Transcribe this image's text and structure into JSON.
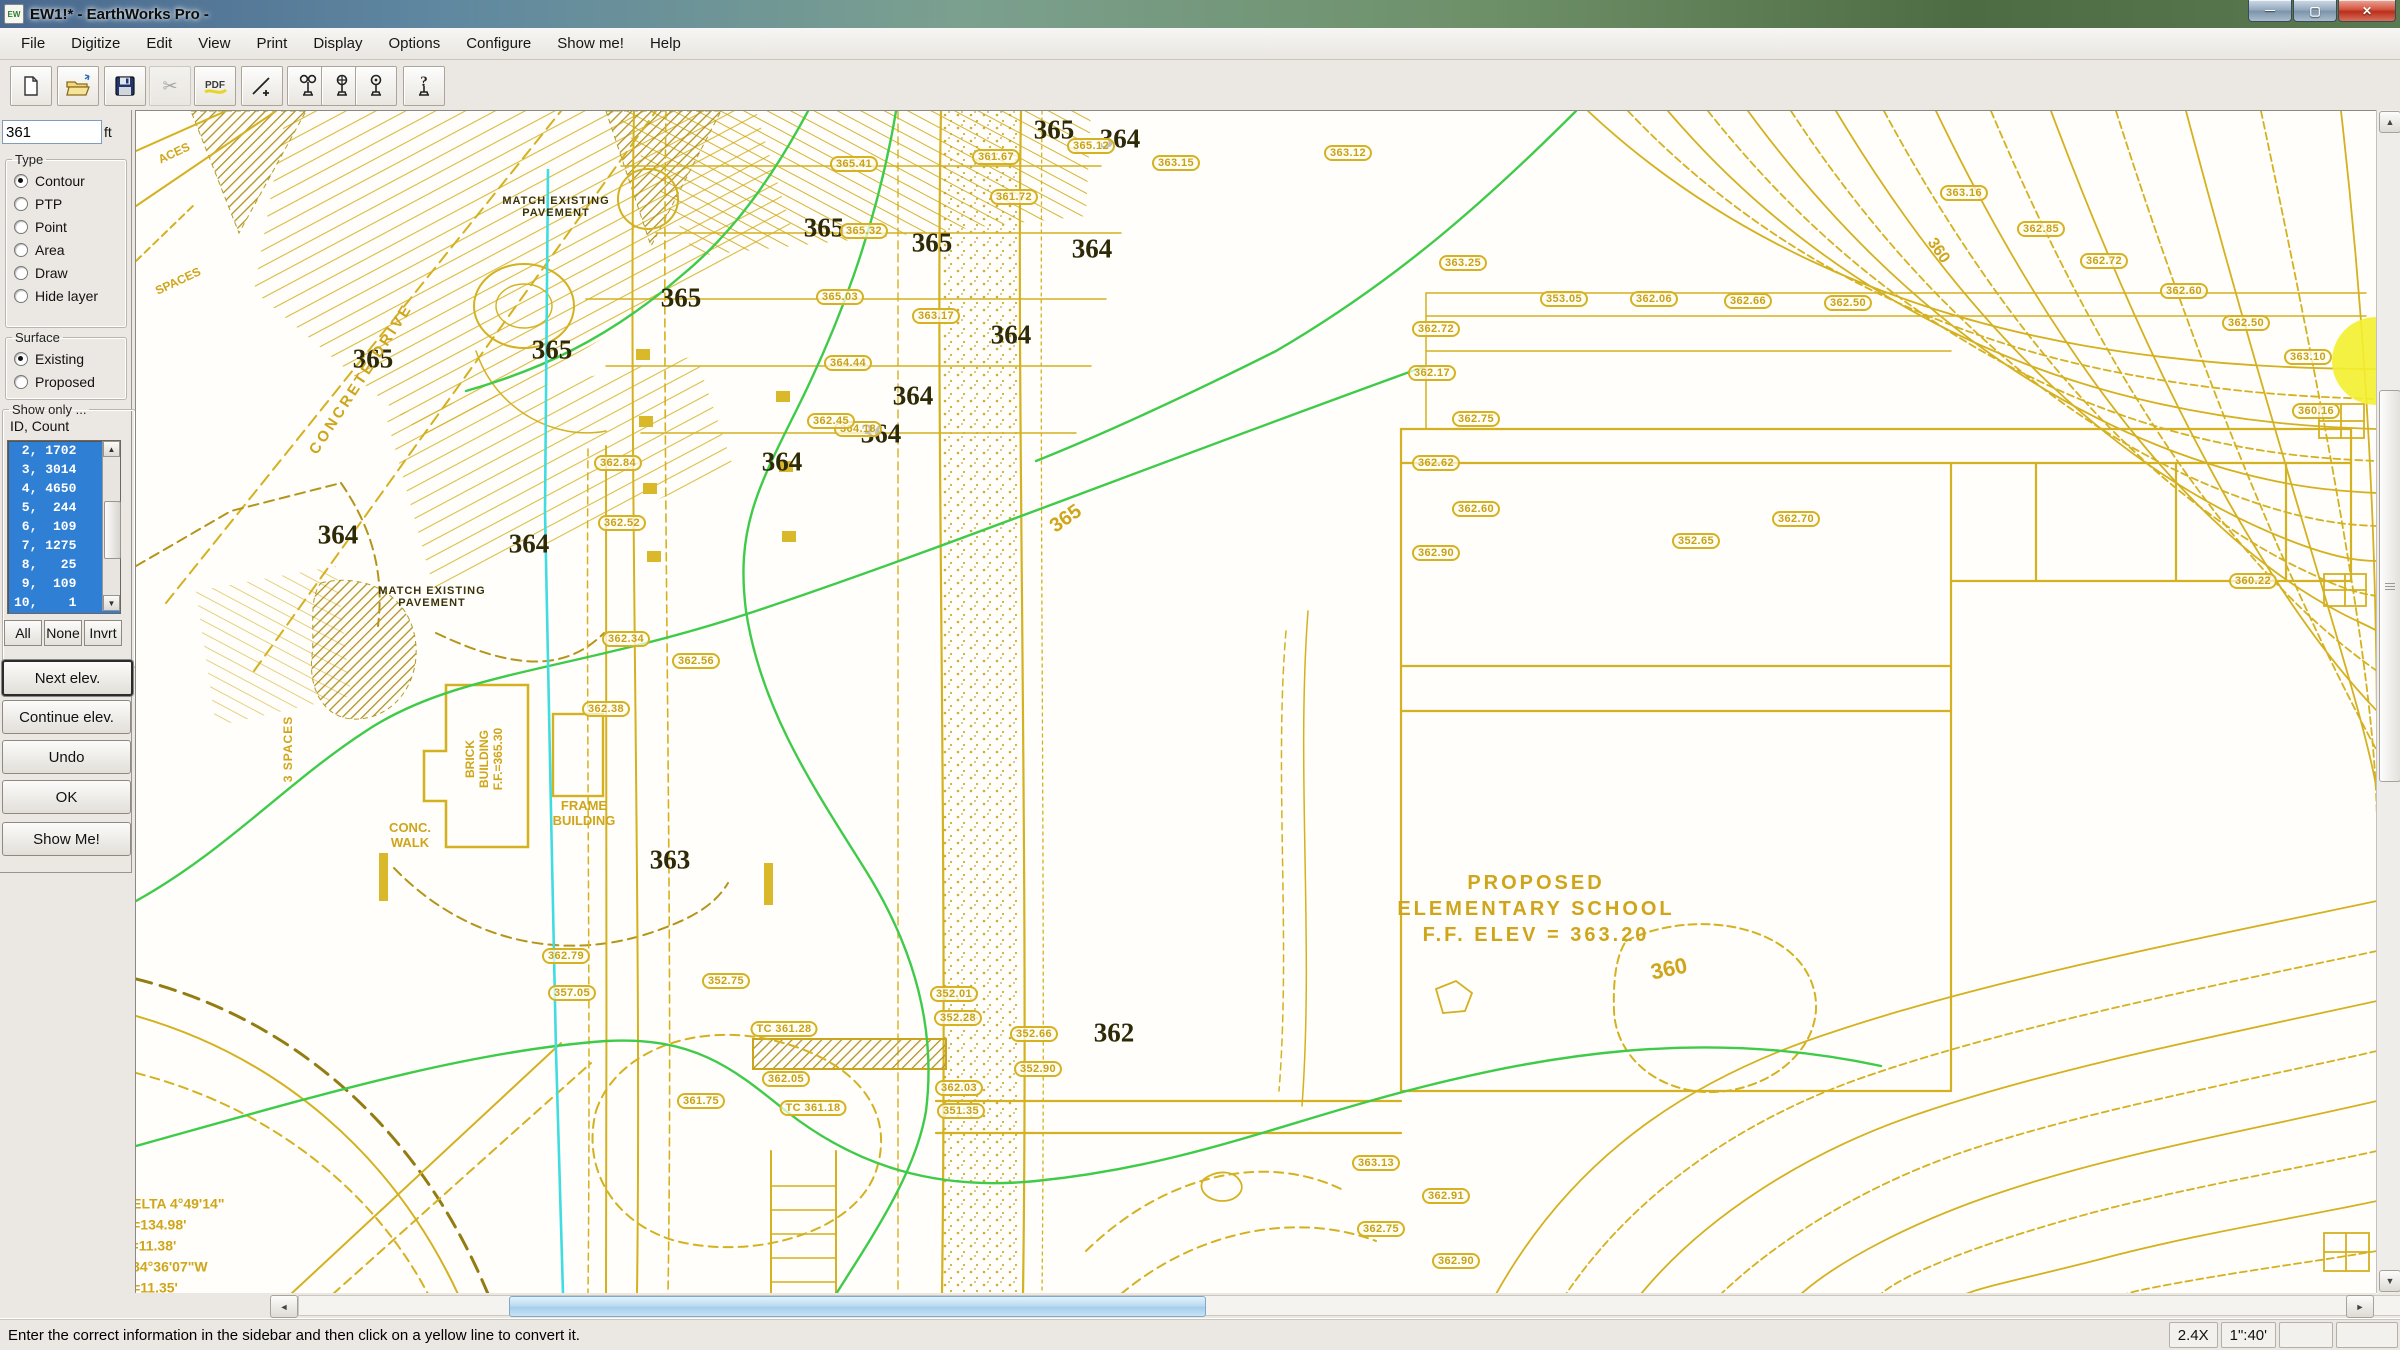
{
  "window": {
    "title": "EW1!* - EarthWorks Pro -",
    "app_icon_text": "EW",
    "caption_buttons": [
      {
        "name": "minimize-button",
        "glyph": "—"
      },
      {
        "name": "maximize-button",
        "glyph": "▢"
      },
      {
        "name": "close-button",
        "glyph": "✕"
      }
    ]
  },
  "menu_bar": {
    "items": [
      "File",
      "Digitize",
      "Edit",
      "View",
      "Print",
      "Display",
      "Options",
      "Configure",
      "Show me!",
      "Help"
    ]
  },
  "toolbar": {
    "buttons": [
      {
        "name": "new-file-icon",
        "disabled": false
      },
      {
        "name": "open-file-icon",
        "disabled": false
      },
      {
        "name": "save-icon",
        "disabled": false
      },
      {
        "name": "cut-icon",
        "disabled": true
      },
      {
        "name": "pdf-icon",
        "disabled": false
      },
      {
        "name": "digitize-line-icon",
        "disabled": false
      },
      {
        "name": "takeoff-pin-icon",
        "disabled": false
      },
      {
        "name": "takeoff-pin-2-icon",
        "disabled": false
      },
      {
        "name": "takeoff-pin-3-icon",
        "disabled": false
      },
      {
        "name": "help-pin-icon",
        "disabled": false
      }
    ]
  },
  "sidebar": {
    "elevation_value": "361",
    "elevation_unit": "ft",
    "type_group": {
      "label": "Type",
      "options": [
        {
          "label": "Contour",
          "selected": true
        },
        {
          "label": "PTP",
          "selected": false
        },
        {
          "label": "Point",
          "selected": false
        },
        {
          "label": "Area",
          "selected": false
        },
        {
          "label": "Draw",
          "selected": false
        },
        {
          "label": "Hide layer",
          "selected": false
        }
      ]
    },
    "surface_group": {
      "label": "Surface",
      "options": [
        {
          "label": "Existing",
          "selected": true
        },
        {
          "label": "Proposed",
          "selected": false
        }
      ]
    },
    "show_only_group": {
      "label": "Show only ...",
      "id_count_label": "ID, Count",
      "list_items": [
        " 2, 1702",
        " 3, 3014",
        " 4, 4650",
        " 5,  244",
        " 6,  109",
        " 7, 1275",
        " 8,   25",
        " 9,  109",
        "10,    1"
      ],
      "list_buttons": [
        "All",
        "None",
        "Invrt"
      ]
    },
    "action_buttons": [
      {
        "label": "Next elev.",
        "default": true
      },
      {
        "label": "Continue elev.",
        "default": false
      },
      {
        "label": "Undo",
        "default": false
      },
      {
        "label": "OK",
        "default": false
      },
      {
        "label": "Show Me!",
        "default": false
      }
    ]
  },
  "canvas": {
    "colors": {
      "contour_yellow": "#d4b120",
      "contour_green": "#3fcb4a",
      "reference_cyan": "#3fdde2",
      "label_dark": "#2e2906",
      "label_yellow": "#cfa51b"
    },
    "big_labels": [
      {
        "t": "365",
        "x": 918,
        "y": 19
      },
      {
        "t": "364",
        "x": 984,
        "y": 28
      },
      {
        "t": "365",
        "x": 688,
        "y": 117
      },
      {
        "t": "365",
        "x": 796,
        "y": 132
      },
      {
        "t": "364",
        "x": 956,
        "y": 138
      },
      {
        "t": "365",
        "x": 545,
        "y": 187
      },
      {
        "t": "364",
        "x": 875,
        "y": 224
      },
      {
        "t": "365",
        "x": 416,
        "y": 239
      },
      {
        "t": "365",
        "x": 237,
        "y": 248
      },
      {
        "t": "364",
        "x": 777,
        "y": 285
      },
      {
        "t": "364",
        "x": 745,
        "y": 323
      },
      {
        "t": "364",
        "x": 646,
        "y": 351
      },
      {
        "t": "364",
        "x": 202,
        "y": 424
      },
      {
        "t": "364",
        "x": 393,
        "y": 433
      },
      {
        "t": "363",
        "x": 534,
        "y": 749
      },
      {
        "t": "362",
        "x": 978,
        "y": 922
      }
    ],
    "boxed_labels": [
      {
        "v": "361.67",
        "x": 860,
        "y": 46
      },
      {
        "v": "361.72",
        "x": 878,
        "y": 86
      },
      {
        "v": "365.12",
        "x": 955,
        "y": 35
      },
      {
        "v": "363.15",
        "x": 1040,
        "y": 52
      },
      {
        "v": "363.12",
        "x": 1212,
        "y": 42
      },
      {
        "v": "365.41",
        "x": 718,
        "y": 53
      },
      {
        "v": "365.32",
        "x": 728,
        "y": 120
      },
      {
        "v": "365.03",
        "x": 704,
        "y": 186
      },
      {
        "v": "364.44",
        "x": 712,
        "y": 252
      },
      {
        "v": "364.18",
        "x": 722,
        "y": 318
      },
      {
        "v": "363.17",
        "x": 800,
        "y": 205
      },
      {
        "v": "362.45",
        "x": 695,
        "y": 310
      },
      {
        "v": "362.84",
        "x": 482,
        "y": 352
      },
      {
        "v": "362.52",
        "x": 486,
        "y": 412
      },
      {
        "v": "362.34",
        "x": 490,
        "y": 528
      },
      {
        "v": "362.56",
        "x": 560,
        "y": 550
      },
      {
        "v": "362.38",
        "x": 470,
        "y": 598
      },
      {
        "v": "362.79",
        "x": 430,
        "y": 845
      },
      {
        "v": "357.05",
        "x": 436,
        "y": 882
      },
      {
        "v": "352.75",
        "x": 590,
        "y": 870
      },
      {
        "v": "352.01",
        "x": 818,
        "y": 883
      },
      {
        "v": "352.28",
        "x": 822,
        "y": 907
      },
      {
        "v": "352.66",
        "x": 898,
        "y": 923
      },
      {
        "v": "352.90",
        "x": 902,
        "y": 958
      },
      {
        "v": "362.03",
        "x": 823,
        "y": 977
      },
      {
        "v": "351.35",
        "x": 825,
        "y": 1000
      },
      {
        "v": "361.75",
        "x": 565,
        "y": 990
      },
      {
        "v": "362.05",
        "x": 650,
        "y": 968
      },
      {
        "v": "TC 361.18",
        "x": 677,
        "y": 997
      },
      {
        "v": "TC 361.28",
        "x": 648,
        "y": 918
      },
      {
        "v": "363.25",
        "x": 1327,
        "y": 152
      },
      {
        "v": "353.05",
        "x": 1428,
        "y": 188
      },
      {
        "v": "362.06",
        "x": 1518,
        "y": 188
      },
      {
        "v": "362.66",
        "x": 1612,
        "y": 190
      },
      {
        "v": "362.50",
        "x": 1712,
        "y": 192
      },
      {
        "v": "362.72",
        "x": 1300,
        "y": 218
      },
      {
        "v": "362.17",
        "x": 1296,
        "y": 262
      },
      {
        "v": "362.75",
        "x": 1340,
        "y": 308
      },
      {
        "v": "362.62",
        "x": 1300,
        "y": 352
      },
      {
        "v": "362.60",
        "x": 1340,
        "y": 398
      },
      {
        "v": "362.90",
        "x": 1300,
        "y": 442
      },
      {
        "v": "362.70",
        "x": 1660,
        "y": 408
      },
      {
        "v": "352.65",
        "x": 1560,
        "y": 430
      },
      {
        "v": "363.16",
        "x": 1828,
        "y": 82
      },
      {
        "v": "362.85",
        "x": 1905,
        "y": 118
      },
      {
        "v": "362.72",
        "x": 1968,
        "y": 150
      },
      {
        "v": "362.60",
        "x": 2048,
        "y": 180
      },
      {
        "v": "362.50",
        "x": 2110,
        "y": 212
      },
      {
        "v": "363.10",
        "x": 2172,
        "y": 246
      },
      {
        "v": "360.16",
        "x": 2180,
        "y": 300
      },
      {
        "v": "360.22",
        "x": 2117,
        "y": 470
      },
      {
        "v": "363.13",
        "x": 1240,
        "y": 1052
      },
      {
        "v": "362.91",
        "x": 1310,
        "y": 1085
      },
      {
        "v": "362.75",
        "x": 1245,
        "y": 1118
      },
      {
        "v": "362.90",
        "x": 1320,
        "y": 1150
      }
    ],
    "text_labels": [
      {
        "lines": [
          "MATCH EXISTING",
          "PAVEMENT"
        ],
        "x": 420,
        "y": 96,
        "fs": 11,
        "c": "dark",
        "ls": 1
      },
      {
        "lines": [
          "MATCH EXISTING",
          "PAVEMENT"
        ],
        "x": 296,
        "y": 486,
        "fs": 11,
        "c": "dark",
        "ls": 1
      },
      {
        "lines": [
          "CONCRETE  DRIVE"
        ],
        "x": 225,
        "y": 268,
        "fs": 15,
        "c": "yellow",
        "r": -57,
        "ls": 3
      },
      {
        "lines": [
          "3 SPACES"
        ],
        "x": 152,
        "y": 638,
        "fs": 12,
        "c": "yellow",
        "r": -90,
        "ls": 1
      },
      {
        "lines": [
          "SPACES"
        ],
        "x": 42,
        "y": 170,
        "fs": 12,
        "c": "yellow",
        "r": -25
      },
      {
        "lines": [
          "ACES"
        ],
        "x": 38,
        "y": 42,
        "fs": 12,
        "c": "yellow",
        "r": -25
      },
      {
        "lines": [
          "BRICK",
          "BUILDING",
          "F.F.=365.30"
        ],
        "x": 348,
        "y": 648,
        "fs": 12,
        "c": "yellow",
        "r": -90,
        "lh": 14
      },
      {
        "lines": [
          "FRAME",
          "BUILDING"
        ],
        "x": 448,
        "y": 702,
        "fs": 13,
        "c": "yellow"
      },
      {
        "lines": [
          "CONC.",
          "WALK"
        ],
        "x": 274,
        "y": 724,
        "fs": 13,
        "c": "yellow"
      },
      {
        "lines": [
          "PROPOSED",
          "ELEMENTARY SCHOOL",
          "F.F. ELEV = 363.20"
        ],
        "x": 1400,
        "y": 798,
        "fs": 20,
        "c": "yellow",
        "ls": 3,
        "lh": 26
      },
      {
        "lines": [
          "DELTA 4°49'14\"",
          "R=134.98'",
          "L=11.38'",
          "N34°36'07\"W",
          "C=11.35'"
        ],
        "x": -14,
        "y": 1135,
        "fs": 14,
        "c": "yellow",
        "align": "left",
        "lh": 21
      },
      {
        "lines": [
          "360"
        ],
        "x": 1533,
        "y": 858,
        "fs": 22,
        "c": "yellow",
        "r": -12
      },
      {
        "lines": [
          "365"
        ],
        "x": 930,
        "y": 408,
        "fs": 20,
        "c": "yellow",
        "r": -35
      },
      {
        "lines": [
          "360"
        ],
        "x": 1802,
        "y": 140,
        "fs": 16,
        "c": "yellow",
        "r": 55
      }
    ]
  },
  "status_bar": {
    "message": "Enter the correct information in the sidebar and then click on a yellow line to convert it.",
    "zoom_level": "2.4X",
    "scale": "1\":40'"
  }
}
